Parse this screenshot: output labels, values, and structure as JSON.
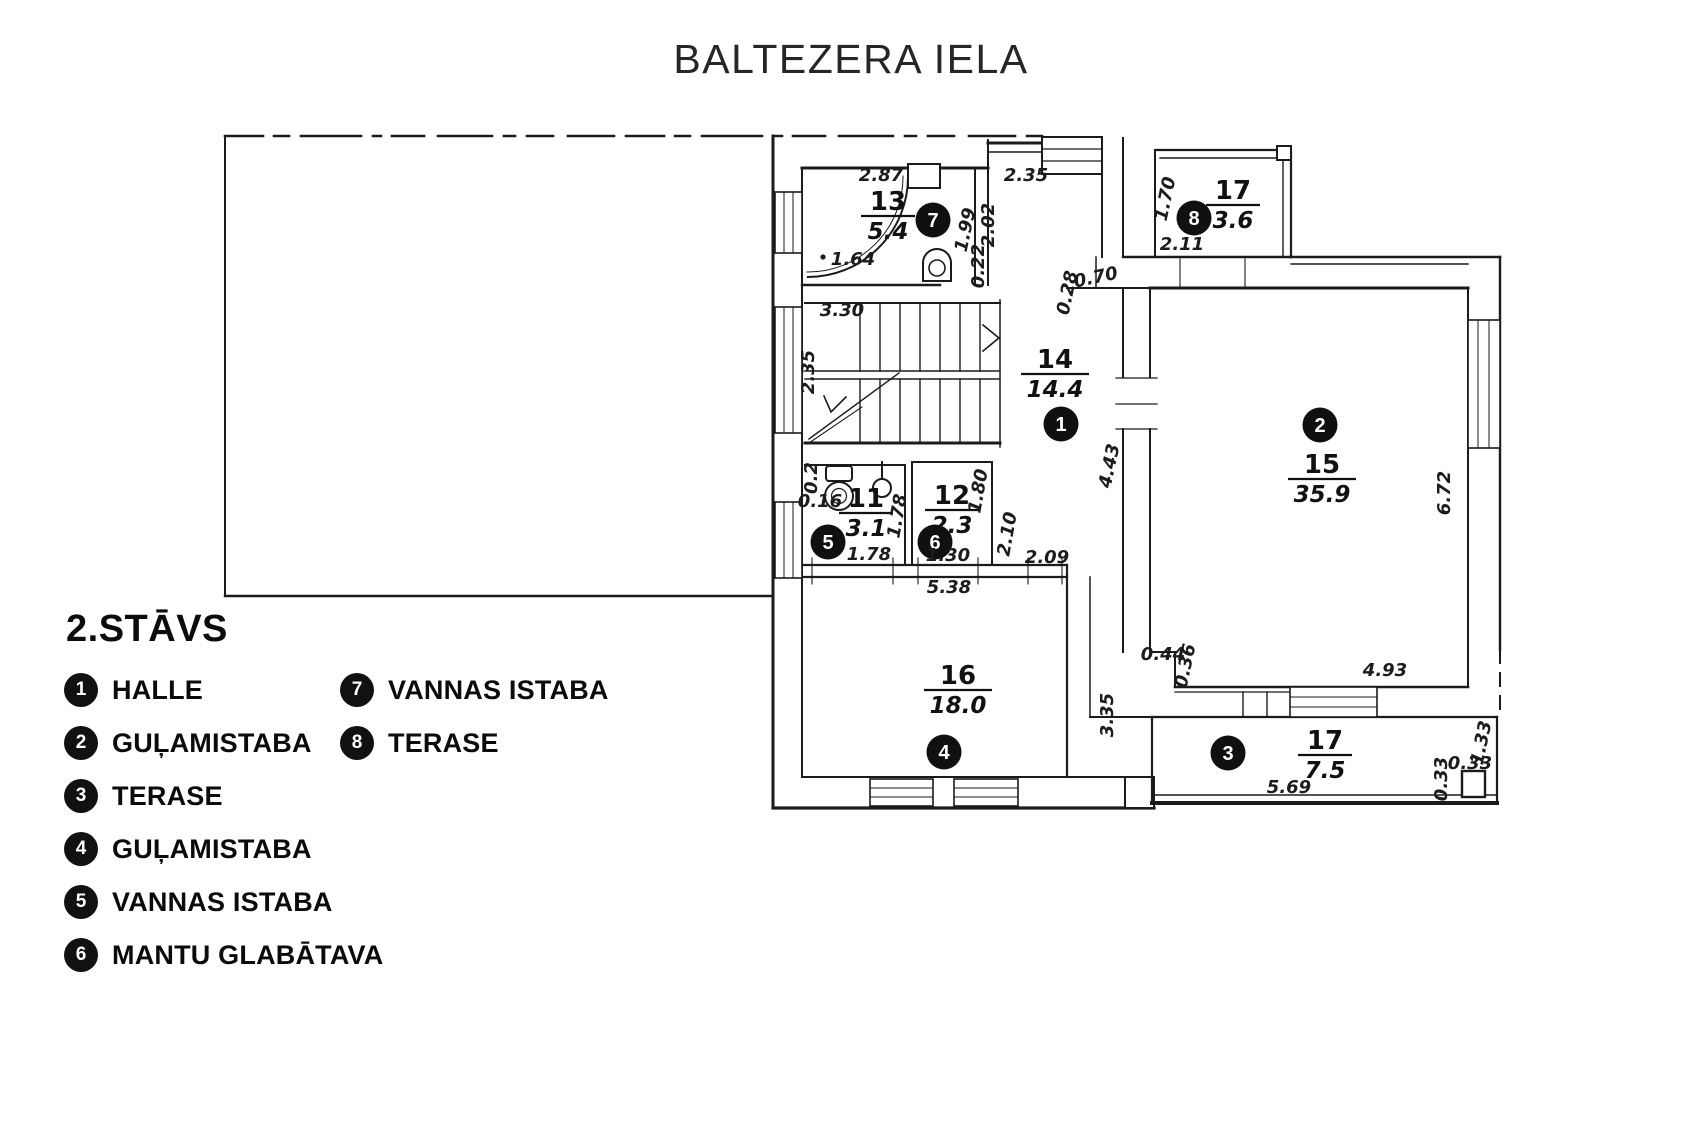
{
  "title": "BALTEZERA IELA",
  "colors": {
    "ink": "#1b1b1b",
    "badge_bg": "#111111",
    "badge_text": "#ffffff"
  },
  "legend": {
    "heading": "2.STĀVS",
    "items": [
      {
        "num": "1",
        "label": "HALLE"
      },
      {
        "num": "2",
        "label": "GUĻAMISTABA"
      },
      {
        "num": "3",
        "label": "TERASE"
      },
      {
        "num": "4",
        "label": "GUĻAMISTABA"
      },
      {
        "num": "5",
        "label": "VANNAS ISTABA"
      },
      {
        "num": "6",
        "label": "MANTU GLABĀTAVA"
      },
      {
        "num": "7",
        "label": "VANNAS ISTABA"
      },
      {
        "num": "8",
        "label": "TERASE"
      }
    ]
  },
  "plan": {
    "rooms": [
      {
        "badge": "7",
        "number": "13",
        "area": "5.4",
        "cx": 888,
        "ly": 210,
        "bx": 933,
        "by": 220
      },
      {
        "badge": "1",
        "number": "14",
        "area": "14.4",
        "cx": 1055,
        "ly": 368,
        "bx": 1061,
        "by": 424
      },
      {
        "badge": "8",
        "number": "17",
        "area": "3.6",
        "cx": 1233,
        "ly": 199,
        "bx": 1194,
        "by": 218
      },
      {
        "badge": "2",
        "number": "15",
        "area": "35.9",
        "cx": 1322,
        "ly": 473,
        "bx": 1320,
        "by": 425
      },
      {
        "badge": "5",
        "number": "11",
        "area": "3.1",
        "cx": 866,
        "ly": 507,
        "bx": 828,
        "by": 542
      },
      {
        "badge": "6",
        "number": "12",
        "area": "2.3",
        "cx": 952,
        "ly": 504,
        "bx": 935,
        "by": 542
      },
      {
        "badge": "4",
        "number": "16",
        "area": "18.0",
        "cx": 958,
        "ly": 684,
        "bx": 944,
        "by": 752
      },
      {
        "badge": "3",
        "number": "17",
        "area": "7.5",
        "cx": 1325,
        "ly": 749,
        "bx": 1228,
        "by": 753
      }
    ],
    "dimensions": [
      {
        "t": "2.87",
        "x": 881,
        "y": 181,
        "r": 0
      },
      {
        "t": "1.64",
        "x": 853,
        "y": 265,
        "r": 0
      },
      {
        "t": "0.22",
        "x": 984,
        "y": 266,
        "r": -90
      },
      {
        "t": "1.99",
        "x": 971,
        "y": 231,
        "r": -78
      },
      {
        "t": "2.02",
        "x": 994,
        "y": 225,
        "r": -90
      },
      {
        "t": "2.35",
        "x": 1026,
        "y": 181,
        "r": 0
      },
      {
        "t": "3.30",
        "x": 842,
        "y": 316,
        "r": 0
      },
      {
        "t": "2.35",
        "x": 814,
        "y": 372,
        "r": -90
      },
      {
        "t": "1.70",
        "x": 1171,
        "y": 200,
        "r": -78
      },
      {
        "t": "2.11",
        "x": 1182,
        "y": 250,
        "r": 0
      },
      {
        "t": "0.70",
        "x": 1097,
        "y": 283,
        "r": -12
      },
      {
        "t": "0.28",
        "x": 1073,
        "y": 294,
        "r": -78
      },
      {
        "t": "4.43",
        "x": 1115,
        "y": 467,
        "r": -78
      },
      {
        "t": "0.16",
        "x": 820,
        "y": 507,
        "r": 0
      },
      {
        "t": "0.2",
        "x": 817,
        "y": 478,
        "r": -90
      },
      {
        "t": "1.78",
        "x": 869,
        "y": 560,
        "r": 0
      },
      {
        "t": "1.78",
        "x": 903,
        "y": 517,
        "r": -80
      },
      {
        "t": "1.80",
        "x": 984,
        "y": 492,
        "r": -80
      },
      {
        "t": "2.10",
        "x": 1013,
        "y": 535,
        "r": -80
      },
      {
        "t": "1.30",
        "x": 948,
        "y": 561,
        "r": 0
      },
      {
        "t": "2.09",
        "x": 1047,
        "y": 563,
        "r": 0
      },
      {
        "t": "5.38",
        "x": 949,
        "y": 593,
        "r": 0
      },
      {
        "t": "3.35",
        "x": 1113,
        "y": 715,
        "r": -90
      },
      {
        "t": "0.44",
        "x": 1163,
        "y": 660,
        "r": 0
      },
      {
        "t": "0.36",
        "x": 1191,
        "y": 667,
        "r": -78
      },
      {
        "t": "4.93",
        "x": 1385,
        "y": 676,
        "r": 0
      },
      {
        "t": "6.72",
        "x": 1450,
        "y": 493,
        "r": -90
      },
      {
        "t": "5.69",
        "x": 1289,
        "y": 793,
        "r": 0
      },
      {
        "t": "0.33",
        "x": 1470,
        "y": 769,
        "r": 0
      },
      {
        "t": "0.33",
        "x": 1447,
        "y": 779,
        "r": -90
      },
      {
        "t": "1.33",
        "x": 1487,
        "y": 744,
        "r": -78
      }
    ]
  }
}
